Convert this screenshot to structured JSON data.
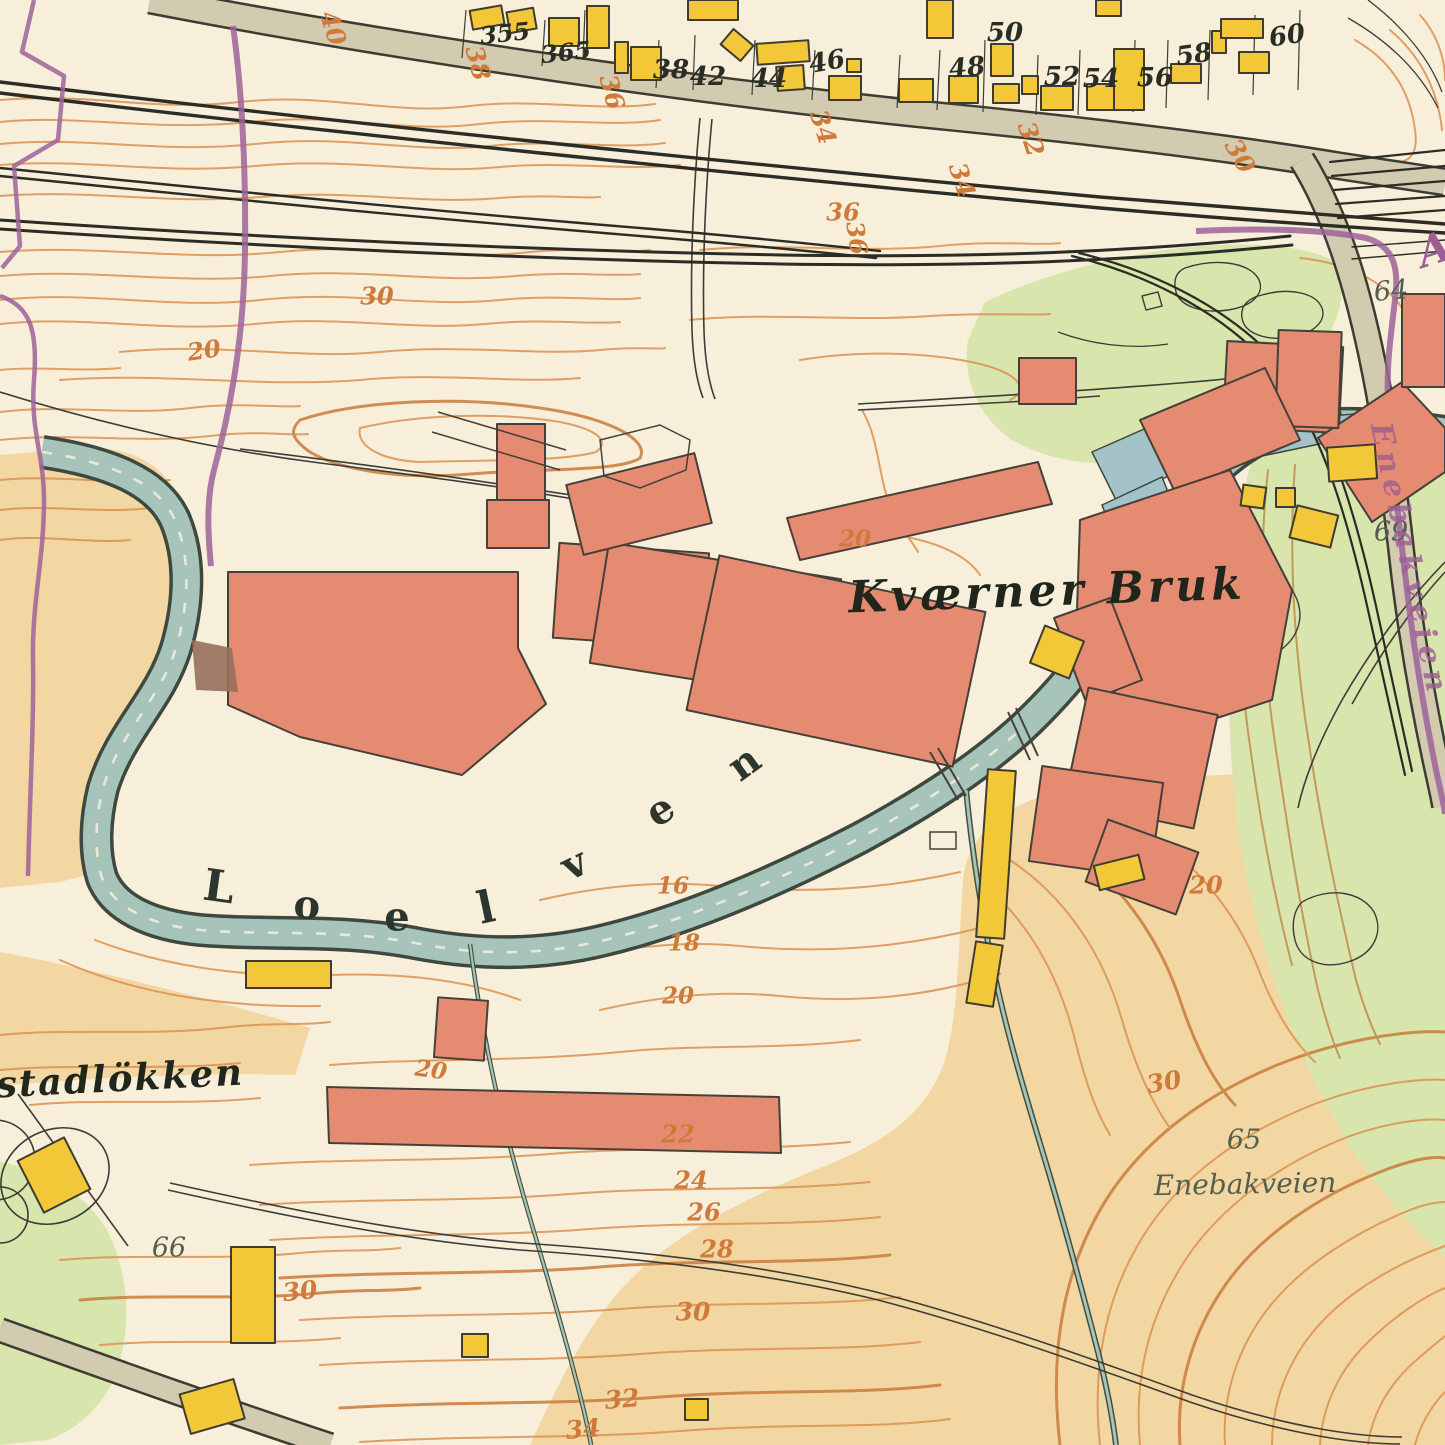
{
  "map": {
    "description": "Historic topographic town map sheet, Kvaerner Bruk / Loelven area",
    "colors": {
      "background_cream": "#f7efda",
      "terrain_tan": "#f3d7a2",
      "vegetation_green": "#d8e5ac",
      "contour_orange": "#db9150",
      "contour_bold": "#c97c3c",
      "river_fill": "#a7c4ba",
      "channel_blue": "#a4c3c9",
      "building_red": "#e58b71",
      "building_yellow": "#f3c838",
      "road_gray": "#d2cbb0",
      "railway_black": "#2c2c26",
      "boundary_purple": "#9d639a",
      "label_orange": "#cf7a3b",
      "label_gray": "#565f4d"
    }
  },
  "labels": [
    {
      "name": "house-number-355",
      "text": "355",
      "x": 505,
      "y": 33,
      "size": 24,
      "rot": -6,
      "cls": "house"
    },
    {
      "name": "house-number-365",
      "text": "365",
      "x": 566,
      "y": 52,
      "size": 24,
      "rot": -6,
      "cls": "house"
    },
    {
      "name": "house-number-38",
      "text": "38",
      "x": 671,
      "y": 70,
      "size": 26,
      "rot": 0,
      "cls": "house"
    },
    {
      "name": "house-number-42",
      "text": "42",
      "x": 708,
      "y": 77,
      "size": 26,
      "rot": 0,
      "cls": "house"
    },
    {
      "name": "house-number-44",
      "text": "44",
      "x": 769,
      "y": 79,
      "size": 26,
      "rot": 0,
      "cls": "house"
    },
    {
      "name": "house-number-46",
      "text": "46",
      "x": 827,
      "y": 62,
      "size": 26,
      "rot": -10,
      "cls": "house"
    },
    {
      "name": "house-number-48",
      "text": "48",
      "x": 967,
      "y": 68,
      "size": 26,
      "rot": -6,
      "cls": "house"
    },
    {
      "name": "house-number-50",
      "text": "50",
      "x": 1005,
      "y": 33,
      "size": 26,
      "rot": 0,
      "cls": "house"
    },
    {
      "name": "house-number-52",
      "text": "52",
      "x": 1062,
      "y": 77,
      "size": 26,
      "rot": 0,
      "cls": "house"
    },
    {
      "name": "house-number-54",
      "text": "54",
      "x": 1101,
      "y": 79,
      "size": 26,
      "rot": 0,
      "cls": "house"
    },
    {
      "name": "house-number-56",
      "text": "56",
      "x": 1155,
      "y": 78,
      "size": 26,
      "rot": 0,
      "cls": "house"
    },
    {
      "name": "house-number-58",
      "text": "58",
      "x": 1194,
      "y": 55,
      "size": 26,
      "rot": -8,
      "cls": "house"
    },
    {
      "name": "house-number-60",
      "text": "60",
      "x": 1287,
      "y": 36,
      "size": 26,
      "rot": -8,
      "cls": "house"
    },
    {
      "name": "contour-40",
      "text": "40",
      "x": 333,
      "y": 28,
      "size": 25,
      "rot": 72,
      "cls": "orange"
    },
    {
      "name": "contour-38",
      "text": "38",
      "x": 478,
      "y": 63,
      "size": 25,
      "rot": 75,
      "cls": "orange"
    },
    {
      "name": "contour-36-road",
      "text": "36",
      "x": 612,
      "y": 92,
      "size": 25,
      "rot": 75,
      "cls": "orange"
    },
    {
      "name": "contour-34-road",
      "text": "34",
      "x": 823,
      "y": 127,
      "size": 25,
      "rot": 72,
      "cls": "orange"
    },
    {
      "name": "contour-32",
      "text": "32",
      "x": 1031,
      "y": 139,
      "size": 25,
      "rot": 72,
      "cls": "orange"
    },
    {
      "name": "contour-34b",
      "text": "34",
      "x": 962,
      "y": 180,
      "size": 25,
      "rot": 72,
      "cls": "orange"
    },
    {
      "name": "contour-30-topright",
      "text": "30",
      "x": 1240,
      "y": 156,
      "size": 25,
      "rot": 60,
      "cls": "orange"
    },
    {
      "name": "contour-36a",
      "text": "36",
      "x": 843,
      "y": 212,
      "size": 24,
      "rot": 0,
      "cls": "orange"
    },
    {
      "name": "contour-36b",
      "text": "36",
      "x": 857,
      "y": 238,
      "size": 24,
      "rot": 82,
      "cls": "orange"
    },
    {
      "name": "contour-30-mid",
      "text": "30",
      "x": 377,
      "y": 296,
      "size": 24,
      "rot": 0,
      "cls": "orange"
    },
    {
      "name": "contour-20-left",
      "text": "20",
      "x": 204,
      "y": 350,
      "size": 24,
      "rot": -8,
      "cls": "orange"
    },
    {
      "name": "contour-20-factory",
      "text": "20",
      "x": 855,
      "y": 539,
      "size": 23,
      "rot": 0,
      "cls": "orange"
    },
    {
      "name": "contour-16",
      "text": "16",
      "x": 673,
      "y": 886,
      "size": 23,
      "rot": 0,
      "cls": "orange"
    },
    {
      "name": "contour-18",
      "text": "18",
      "x": 684,
      "y": 943,
      "size": 23,
      "rot": 0,
      "cls": "orange"
    },
    {
      "name": "contour-20-river",
      "text": "20",
      "x": 678,
      "y": 996,
      "size": 23,
      "rot": 0,
      "cls": "orange"
    },
    {
      "name": "contour-20-west",
      "text": "20",
      "x": 431,
      "y": 1070,
      "size": 23,
      "rot": 8,
      "cls": "orange"
    },
    {
      "name": "contour-22",
      "text": "22",
      "x": 678,
      "y": 1134,
      "size": 24,
      "rot": 0,
      "cls": "orange"
    },
    {
      "name": "contour-24",
      "text": "24",
      "x": 691,
      "y": 1180,
      "size": 24,
      "rot": 0,
      "cls": "orange"
    },
    {
      "name": "contour-26",
      "text": "26",
      "x": 704,
      "y": 1212,
      "size": 24,
      "rot": 0,
      "cls": "orange"
    },
    {
      "name": "contour-28",
      "text": "28",
      "x": 717,
      "y": 1249,
      "size": 24,
      "rot": 0,
      "cls": "orange"
    },
    {
      "name": "contour-30-bottom",
      "text": "30",
      "x": 693,
      "y": 1312,
      "size": 25,
      "rot": 0,
      "cls": "orange"
    },
    {
      "name": "contour-32-bottom",
      "text": "32",
      "x": 622,
      "y": 1399,
      "size": 25,
      "rot": -5,
      "cls": "orange"
    },
    {
      "name": "contour-34-bottom",
      "text": "34",
      "x": 583,
      "y": 1429,
      "size": 25,
      "rot": -5,
      "cls": "orange"
    },
    {
      "name": "contour-30-bl",
      "text": "30",
      "x": 300,
      "y": 1291,
      "size": 25,
      "rot": -6,
      "cls": "orange"
    },
    {
      "name": "contour-30-se",
      "text": "30",
      "x": 1164,
      "y": 1082,
      "size": 25,
      "rot": -10,
      "cls": "orange"
    },
    {
      "name": "contour-20-east",
      "text": "20",
      "x": 1206,
      "y": 885,
      "size": 24,
      "rot": 0,
      "cls": "orange"
    },
    {
      "name": "parcel-64",
      "text": "64",
      "x": 1391,
      "y": 291,
      "size": 27,
      "rot": -5,
      "cls": "gray"
    },
    {
      "name": "parcel-66",
      "text": "66",
      "x": 169,
      "y": 1248,
      "size": 27,
      "rot": 0,
      "cls": "gray"
    },
    {
      "name": "parcel-69",
      "text": "69",
      "x": 1391,
      "y": 532,
      "size": 27,
      "rot": 0,
      "cls": "gray"
    },
    {
      "name": "parcel-65",
      "text": "65",
      "x": 1244,
      "y": 1140,
      "size": 27,
      "rot": 0,
      "cls": "gray"
    },
    {
      "name": "place-kvaerner-bruk",
      "text": "Kværner Bruk",
      "x": 1047,
      "y": 591,
      "size": 44,
      "rot": -2,
      "cls": "name big"
    },
    {
      "name": "place-stadlokken",
      "text": "stadlökken",
      "x": 120,
      "y": 1078,
      "size": 37,
      "rot": -3,
      "cls": "name"
    },
    {
      "name": "place-enebakveien",
      "text": "Enebakveien",
      "x": 1245,
      "y": 1184,
      "size": 28,
      "rot": -1,
      "cls": "gray"
    },
    {
      "name": "place-letter-a",
      "text": "A",
      "x": 1434,
      "y": 249,
      "size": 42,
      "rot": -18,
      "cls": "purple"
    },
    {
      "name": "roadname-enebakveien",
      "text": "Enebakveien",
      "x": 1409,
      "y": 560,
      "size": 30,
      "rot": 78,
      "cls": "purple roadname"
    },
    {
      "name": "river-letter-1",
      "text": "L",
      "x": 219,
      "y": 887,
      "size": 44,
      "rot": 8,
      "cls": "river-letter"
    },
    {
      "name": "river-letter-2",
      "text": "o",
      "x": 307,
      "y": 905,
      "size": 40,
      "rot": 4,
      "cls": "river-letter"
    },
    {
      "name": "river-letter-3",
      "text": "e",
      "x": 397,
      "y": 917,
      "size": 40,
      "rot": 0,
      "cls": "river-letter"
    },
    {
      "name": "river-letter-4",
      "text": "l",
      "x": 486,
      "y": 908,
      "size": 44,
      "rot": -12,
      "cls": "river-letter"
    },
    {
      "name": "river-letter-5",
      "text": "v",
      "x": 574,
      "y": 864,
      "size": 40,
      "rot": -26,
      "cls": "river-letter"
    },
    {
      "name": "river-letter-6",
      "text": "e",
      "x": 660,
      "y": 810,
      "size": 40,
      "rot": -32,
      "cls": "river-letter"
    },
    {
      "name": "river-letter-7",
      "text": "n",
      "x": 744,
      "y": 763,
      "size": 40,
      "rot": -36,
      "cls": "river-letter"
    }
  ]
}
